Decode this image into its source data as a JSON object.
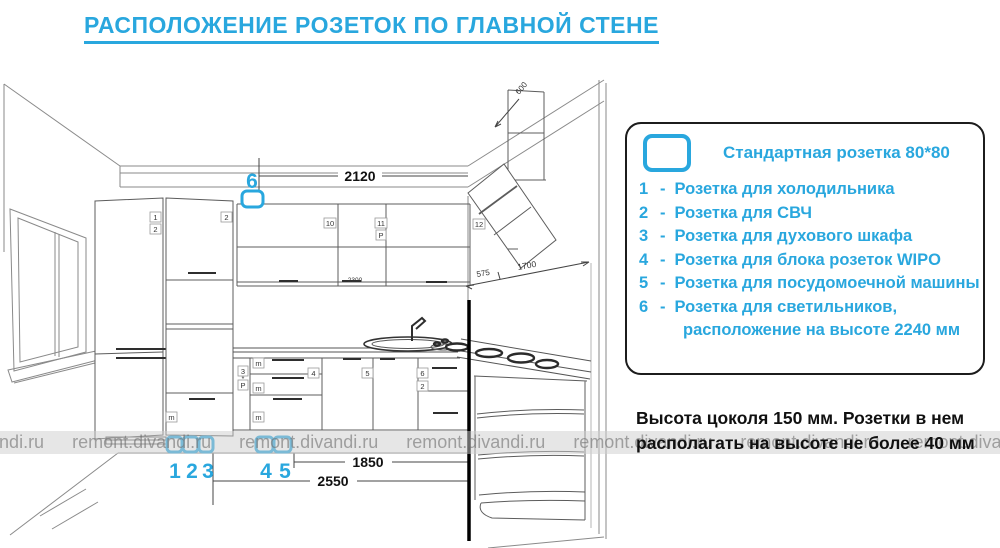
{
  "title": "РАСПОЛОЖЕНИЕ РОЗЕТОК ПО ГЛАВНОЙ СТЕНЕ",
  "watermark": {
    "text": "remont.divandi.ru"
  },
  "legend": {
    "header": "Стандартная розетка 80*80",
    "items": [
      {
        "num": "1",
        "sep": "-",
        "text": "Розетка для холодильника"
      },
      {
        "num": "2",
        "sep": "-",
        "text": "Розетка для СВЧ"
      },
      {
        "num": "3",
        "sep": "-",
        "text": "Розетка для духового шкафа"
      },
      {
        "num": "4",
        "sep": "-",
        "text": "Розетка для блока розеток WIPO"
      },
      {
        "num": "5",
        "sep": "-",
        "text": "Розетка для посудомоечной машины"
      },
      {
        "num": "6",
        "sep": "-",
        "text": "Розетка для светильников,",
        "text2": "расположение на высоте 2240 мм"
      }
    ]
  },
  "note": {
    "line1": "Высота цоколя 150 мм. Розетки в нем",
    "line2": "располагать на высоте не более 40  мм"
  },
  "drawing": {
    "dim_2120": "2120",
    "dim_2300": "2300",
    "dim_600": "600",
    "dim_575": "575",
    "dim_1700": "1700",
    "dim_1850": "1850",
    "dim_2550": "2550",
    "marker_top": "6",
    "marker_1": "1",
    "marker_2": "2",
    "marker_3": "3",
    "marker_4": "4",
    "marker_5": "5",
    "cab_labels": {
      "fridge_1": "1",
      "fridge_2": "2",
      "tall_2": "2",
      "tall_m": "m",
      "wall_10": "10",
      "wall_11": "11",
      "wall_p": "P",
      "wall_12": "12",
      "base_3": "3",
      "base_star": "*",
      "base_p": "P",
      "base_m1": "m",
      "base_m2": "m",
      "base_m3": "m",
      "base_4": "4",
      "base_5": "5",
      "base_6": "6",
      "base_2": "2"
    }
  },
  "colors": {
    "accent": "#29a7de",
    "ink": "#111111",
    "line": "#666666"
  }
}
